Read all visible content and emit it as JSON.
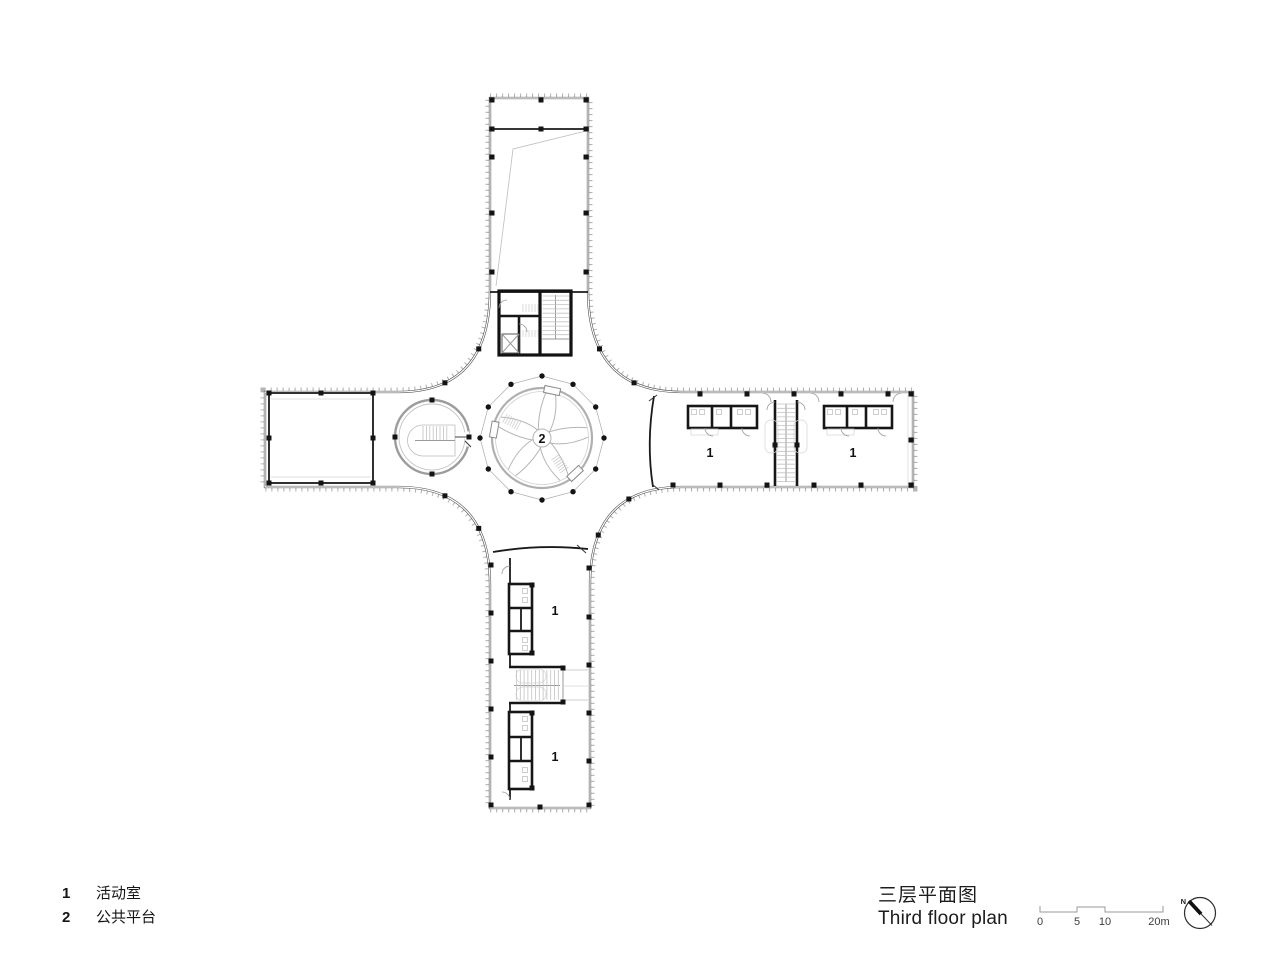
{
  "legend": {
    "items": [
      {
        "num": "1",
        "label": "活动室"
      },
      {
        "num": "2",
        "label": "公共平台"
      }
    ]
  },
  "title_block": {
    "title_zh": "三层平面图",
    "title_en": "Third floor plan"
  },
  "scale_bar": {
    "labels": [
      "0",
      "5",
      "10",
      "20m"
    ]
  },
  "north_arrow": {
    "label": "N"
  },
  "plan": {
    "room_labels": {
      "activity": "1",
      "platform": "2"
    }
  }
}
